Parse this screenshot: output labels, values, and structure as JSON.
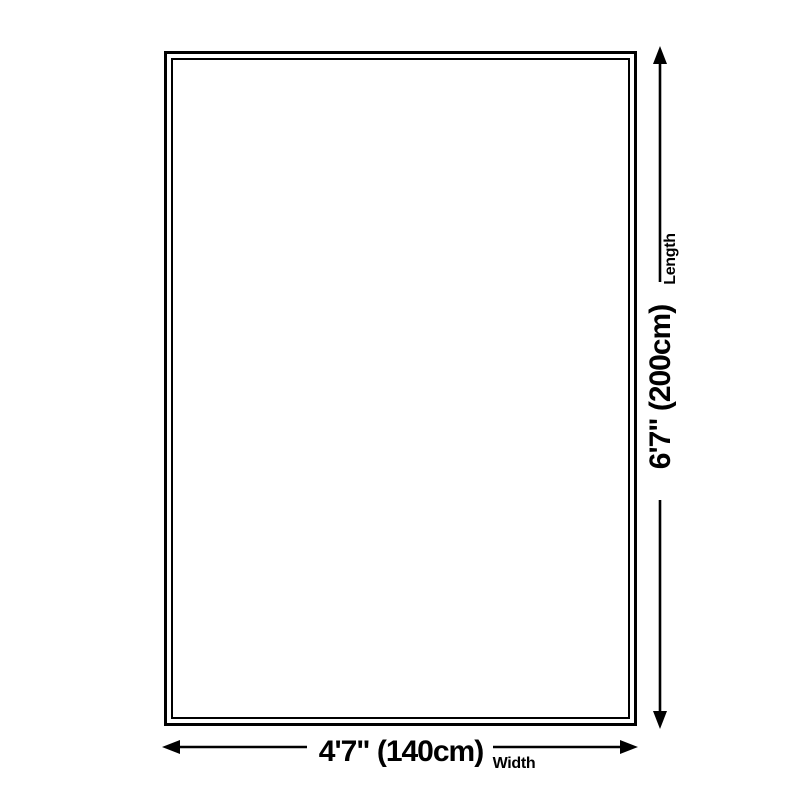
{
  "diagram": {
    "type": "product-dimension-diagram",
    "subject": "rug-outline",
    "colors": {
      "background": "#ffffff",
      "line": "#000000",
      "text": "#000000"
    },
    "length_dimension": {
      "value": "6'7\" (200cm)",
      "label": "Length",
      "orientation": "vertical"
    },
    "width_dimension": {
      "value": "4'7\" (140cm)",
      "label": "Width",
      "orientation": "horizontal"
    }
  }
}
